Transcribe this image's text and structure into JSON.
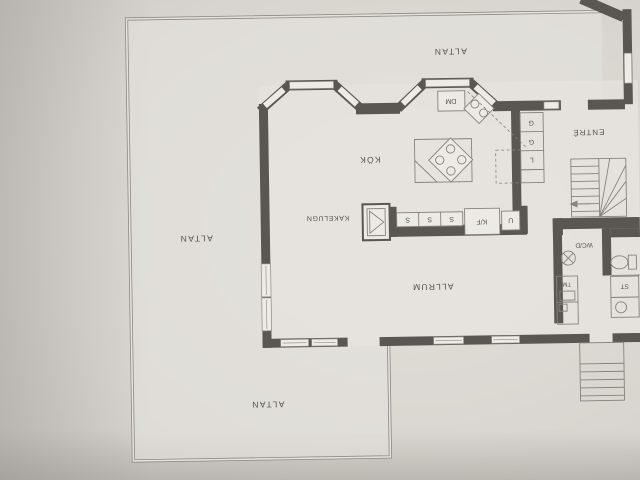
{
  "document": {
    "kind": "floor-plan photograph (upside-down Swedish house plan)",
    "colors": {
      "paper": "#d7d3ce",
      "paper_light": "#e7e4df",
      "wall": "#5a5651",
      "thin_line": "#87827d",
      "text": "#55524e"
    }
  },
  "labels": {
    "altan_north": "ALTAN",
    "altan_west": "ALTAN",
    "altan_south": "ALTAN",
    "kok": "KÖK",
    "kakelugn": "KAKELUGN",
    "allrum": "ALLRUM",
    "entre": "ENTRÉ",
    "wcd": "WC/D",
    "dm": "DM",
    "kf": "K/F",
    "u": "U",
    "s": "S",
    "g": "G",
    "l": "L",
    "tm": "TM",
    "st": "ST"
  }
}
